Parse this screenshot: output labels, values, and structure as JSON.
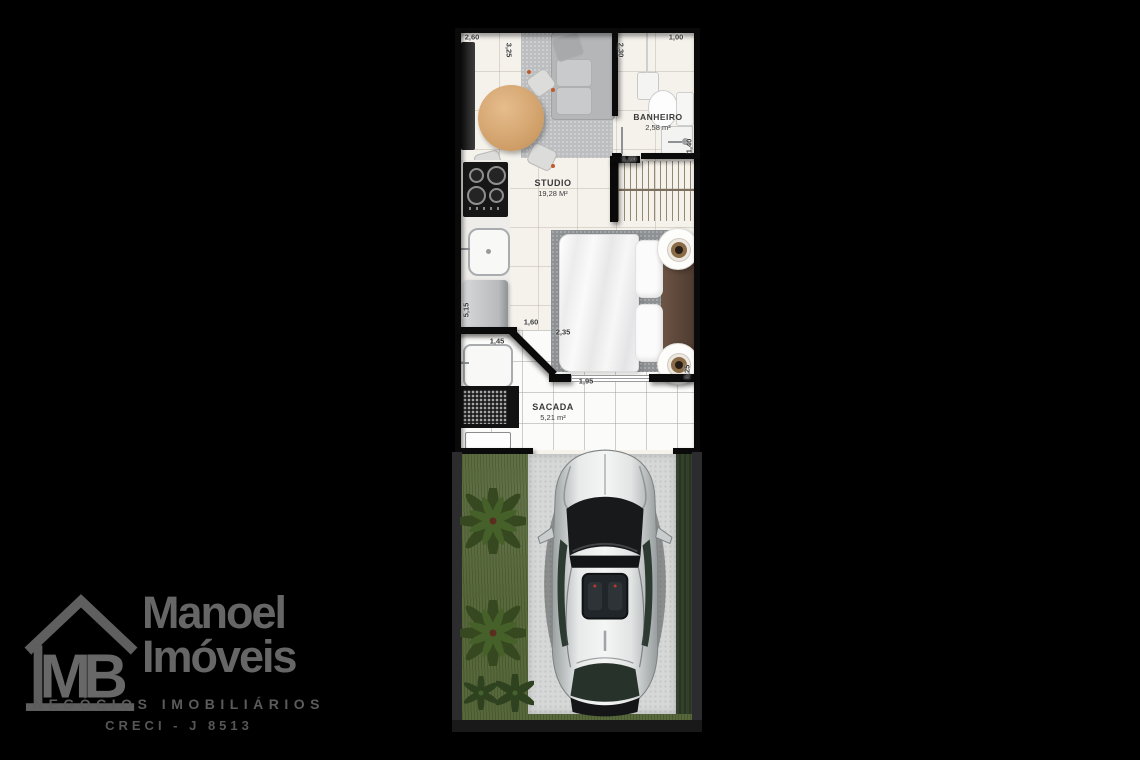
{
  "plan": {
    "rooms": {
      "studio": {
        "name": "STUDIO",
        "area": "19,28 M²"
      },
      "banheiro": {
        "name": "BANHEIRO",
        "area": "2,58 m²"
      },
      "sacada": {
        "name": "SACADA",
        "area": "5,21 m²"
      }
    },
    "dimensions": {
      "living_top": "2,60",
      "living_right": "3,25",
      "bath_left": "2,30",
      "bath_top": "1,00",
      "closet_width": "1,20",
      "bath_right": "1,40",
      "left_wall": "5,15",
      "bed_offset": "1,60",
      "bed_width": "2,35",
      "service_width": "1,45",
      "balcony_door": "1,95",
      "bed_right": "3,25"
    }
  },
  "watermark": {
    "monogram": "MB",
    "brand_line1": "Manoel",
    "brand_line2": "Imóveis",
    "tagline": "NEGÓCIOS IMOBILIÁRIOS",
    "registration": "CRECI - J 8513"
  },
  "colors": {
    "background": "#000000",
    "floor": "#f5f2ec",
    "wall": "#0a0a0a",
    "grass": "#57683a",
    "driveway": "#d6d8d7",
    "logo_gray": "#666666",
    "wood": "#d2a272",
    "headboard": "#5d4a3f"
  }
}
